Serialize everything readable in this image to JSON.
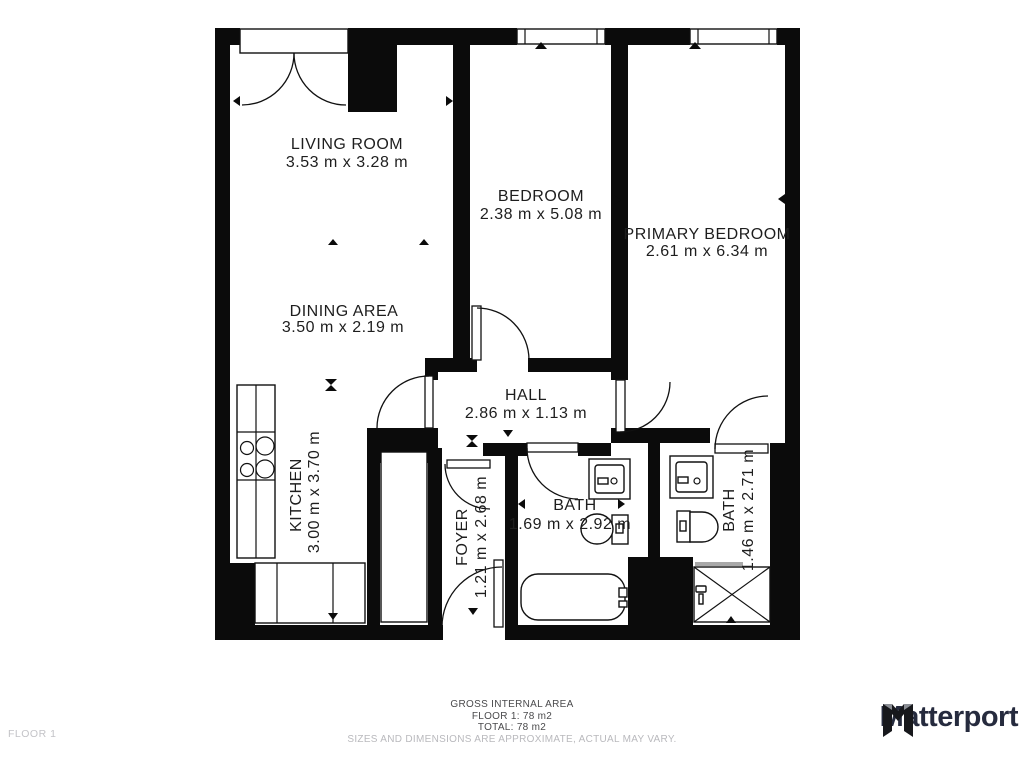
{
  "rooms": {
    "living_room": {
      "name": "LIVING ROOM",
      "dims": "3.53 m x 3.28 m"
    },
    "bedroom": {
      "name": "BEDROOM",
      "dims": "2.38 m x 5.08 m"
    },
    "primary_bedroom": {
      "name": "PRIMARY BEDROOM",
      "dims": "2.61 m x 6.34 m"
    },
    "dining_area": {
      "name": "DINING AREA",
      "dims": "3.50 m x 2.19 m"
    },
    "hall": {
      "name": "HALL",
      "dims": "2.86 m x 1.13 m"
    },
    "kitchen": {
      "name": "KITCHEN",
      "dims": "3.00 m x 3.70 m"
    },
    "foyer": {
      "name": "FOYER",
      "dims": "1.21 m x 2.68 m"
    },
    "bath_1": {
      "name": "BATH",
      "dims": "1.69 m x 2.92 m"
    },
    "bath_2": {
      "name": "BATH",
      "dims": "1.46 m x 2.71 m"
    }
  },
  "footer": {
    "gross_area_title": "GROSS INTERNAL AREA",
    "floor_area": "FLOOR 1: 78 m2",
    "total_area": "TOTAL: 78 m2",
    "disclaimer": "SIZES AND DIMENSIONS ARE APPROXIMATE, ACTUAL MAY VARY.",
    "floor_label": "FLOOR 1"
  },
  "branding": {
    "name": "Matterport"
  },
  "colors": {
    "wall": "#0b0b0b",
    "logo": "#262b3e",
    "faint_text": "#b9b9bd"
  }
}
